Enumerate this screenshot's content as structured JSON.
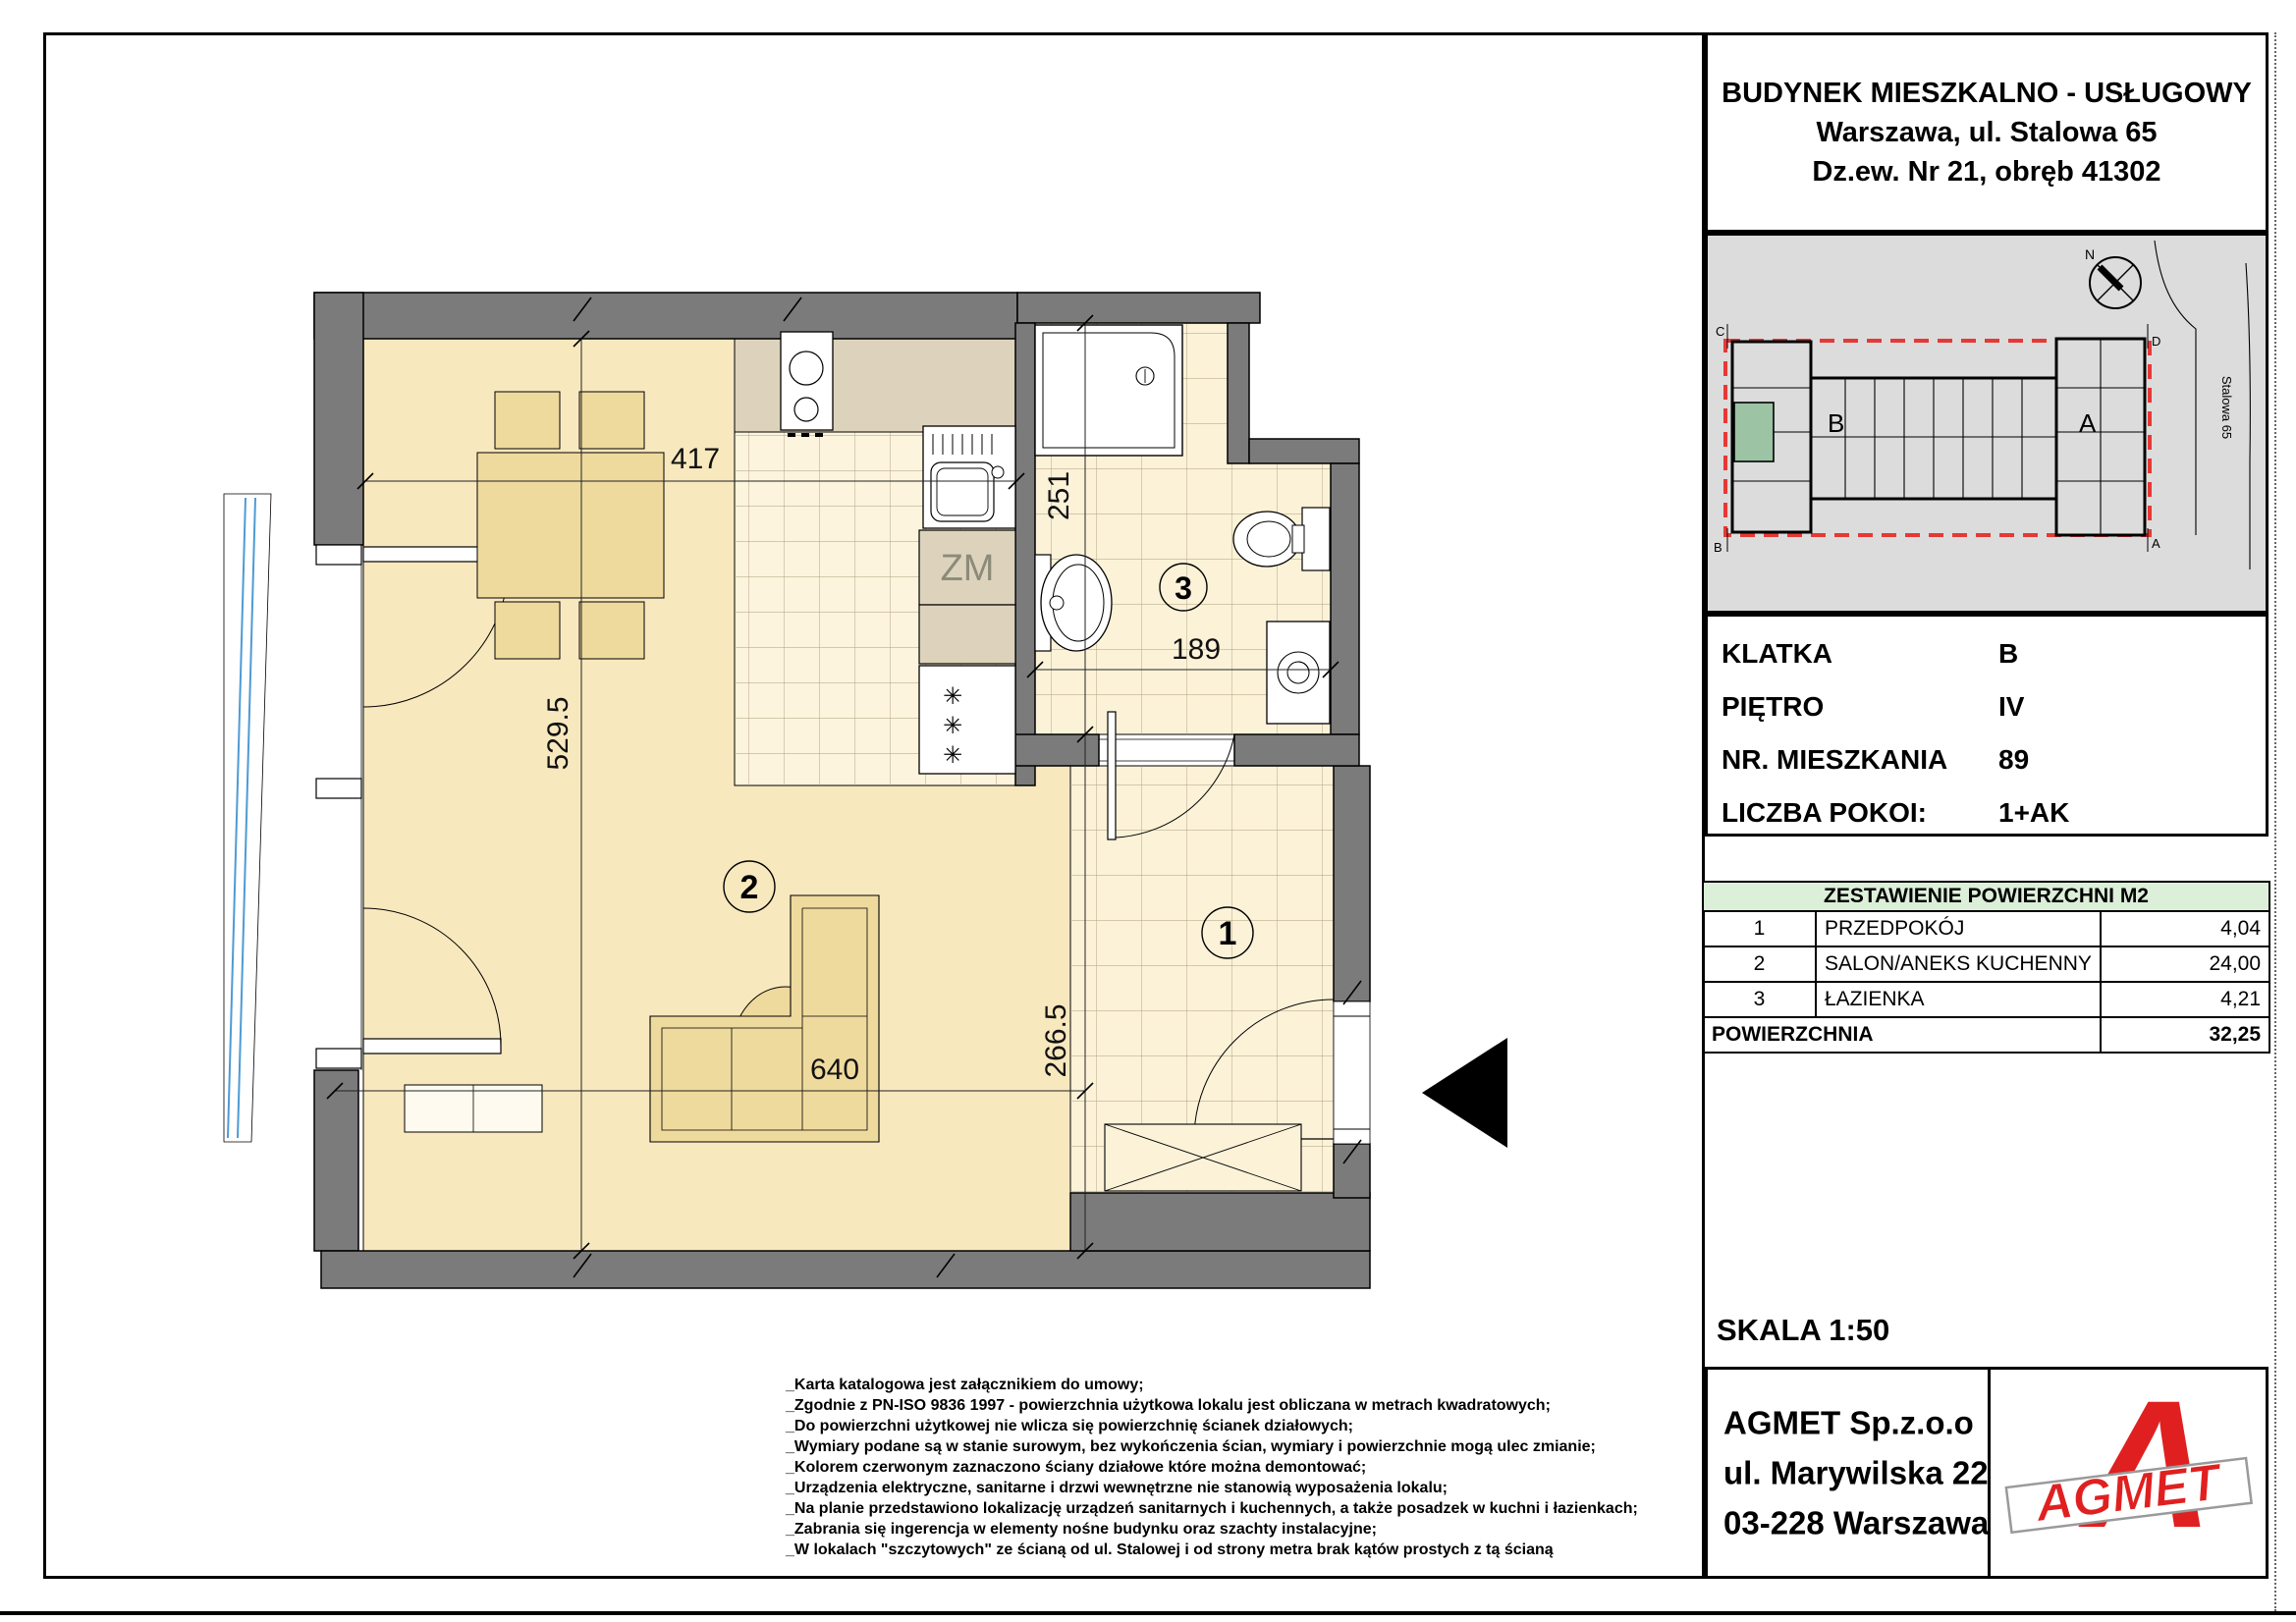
{
  "header": {
    "line1": "BUDYNEK MIESZKALNO - USŁUGOWY",
    "line2": "Warszawa, ul. Stalowa 65",
    "line3": "Dz.ew. Nr 21, obręb 41302"
  },
  "site_plan": {
    "compass": "N",
    "street": "Stalowa 65",
    "corners": {
      "c": "C",
      "d": "D",
      "b": "B",
      "a": "A"
    },
    "stairwell_b": "B",
    "stairwell_a": "A",
    "colors": {
      "background": "#DCDCDC",
      "outline_red": "#E53935",
      "unit_green": "#9CC3A4"
    }
  },
  "info": {
    "klatka_label": "KLATKA",
    "klatka": "B",
    "pietro_label": "PIĘTRO",
    "pietro": "IV",
    "nr_label": "NR. MIESZKANIA",
    "nr": "89",
    "pokoje_label": "LICZBA POKOI:",
    "pokoje": "1+AK"
  },
  "area_table": {
    "title": "ZESTAWIENIE POWIERZCHNI M2",
    "rows": [
      {
        "num": "1",
        "name": "PRZEDPOKÓJ",
        "value": "4,04"
      },
      {
        "num": "2",
        "name": "SALON/ANEKS KUCHENNY",
        "value": "24,00"
      },
      {
        "num": "3",
        "name": "ŁAZIENKA",
        "value": "4,21"
      }
    ],
    "total_label": "POWIERZCHNIA",
    "total_value": "32,25"
  },
  "scale_label": "SKALA 1:50",
  "company": {
    "name": "AGMET Sp.z.o.o",
    "street": "ul. Marywilska 22",
    "city": "03-228 Warszawa",
    "logo_letter": "A",
    "logo_text": "AGMET",
    "logo_color": "#E02020"
  },
  "plan": {
    "dim_top": "417",
    "dim_left": "529.5",
    "dim_bath_v": "251",
    "dim_bath_h": "189",
    "dim_hall_v": "266.5",
    "dim_sofa": "640",
    "room1": "1",
    "room2": "2",
    "room3": "3",
    "zm": "ZM",
    "star": "✳"
  },
  "footnotes": [
    "_Karta katalogowa jest załącznikiem do umowy;",
    "_Zgodnie z PN-ISO 9836 1997 - powierzchnia użytkowa lokalu jest obliczana w metrach kwadratowych;",
    "_Do powierzchni użytkowej nie wlicza się powierzchnię ścianek działowych;",
    "_Wymiary podane są w stanie surowym, bez wykończenia ścian,  wymiary i powierzchnie mogą ulec zmianie;",
    "_Kolorem czerwonym zaznaczono ściany działowe które można demontować;",
    "_Urządzenia elektryczne, sanitarne i drzwi wewnętrzne nie stanowią wyposażenia lokalu;",
    "_Na planie przedstawiono lokalizację urządzeń sanitarnych i kuchennych, a także posadzek w kuchni i łazienkach;",
    "_Zabrania się ingerencja w elementy nośne budynku oraz szachty instalacyjne;",
    "_W lokalach \"szczytowych\" ze ścianą od ul. Stalowej i od strony metra brak kątów prostych z tą ścianą"
  ]
}
